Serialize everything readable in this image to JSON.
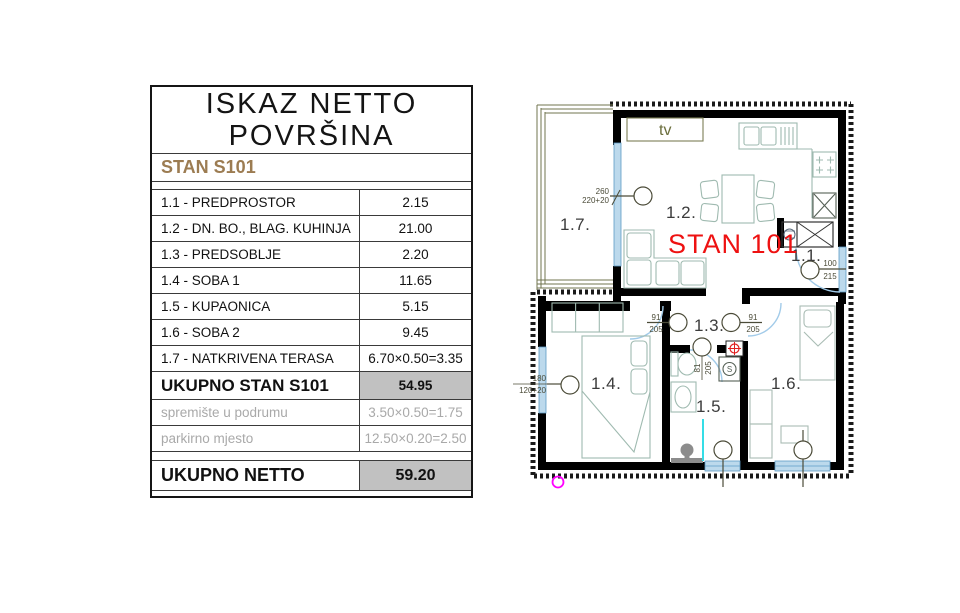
{
  "table": {
    "title_line1": "ISKAZ NETTO",
    "title_line2": "POVRŠINA",
    "unit_header": "STAN S101",
    "rows": [
      {
        "label": "1.1 - PREDPROSTOR",
        "value": "2.15"
      },
      {
        "label": "1.2 - DN. BO., BLAG. KUHINJA",
        "value": "21.00"
      },
      {
        "label": "1.3 - PREDSOBLJE",
        "value": "2.20"
      },
      {
        "label": "1.4 - SOBA 1",
        "value": "11.65"
      },
      {
        "label": "1.5 - KUPAONICA",
        "value": "5.15"
      },
      {
        "label": "1.6 - SOBA 2",
        "value": "9.45"
      },
      {
        "label": "1.7 - NATKRIVENA TERASA",
        "value": "6.70×0.50=3.35"
      }
    ],
    "total_row": {
      "label": "UKUPNO STAN S101",
      "value": "54.95"
    },
    "basement_row": {
      "label": "spremište u podrumu",
      "value": "3.50×0.50=1.75"
    },
    "parking_row": {
      "label": "parkirno mjesto",
      "value": "12.50×0.20=2.50"
    },
    "netto_row": {
      "label": "UKUPNO NETTO",
      "value": "59.20"
    }
  },
  "plan": {
    "unit_label": "STAN 101",
    "tv_label": "tv",
    "rooms": {
      "r11": "1.1.",
      "r12": "1.2.",
      "r13": "1.3.",
      "r14": "1.4.",
      "r15": "1.5.",
      "r16": "1.6.",
      "r17": "1.7."
    },
    "dimensions": {
      "terrace_door_w": "260",
      "terrace_door_h": "220+20",
      "entry_door_w": "100",
      "entry_door_h": "215",
      "hall_door_left_w": "91",
      "hall_door_left_h": "205",
      "hall_door_right_w": "91",
      "hall_door_right_h": "205",
      "bath_door_w": "81",
      "bath_door_h": "205",
      "window14_w": "180",
      "window14_h": "120+20"
    }
  },
  "colors": {
    "unit_label_red": "#ee1111",
    "unit_header_brown": "#9c7c52",
    "total_cell_gray": "#c1c1c1",
    "muted_text_gray": "#a9a9a9",
    "window_blue_fill": "#bcd9ec",
    "door_arc_blue": "#a2cbe9",
    "furniture_green": "#9fbab0",
    "railing_olive": "#70744f",
    "dimension_olive": "#4b4b38",
    "marker_magenta": "#ff00ff",
    "shower_cyan": "#35dde6",
    "target_red": "#e02020"
  }
}
